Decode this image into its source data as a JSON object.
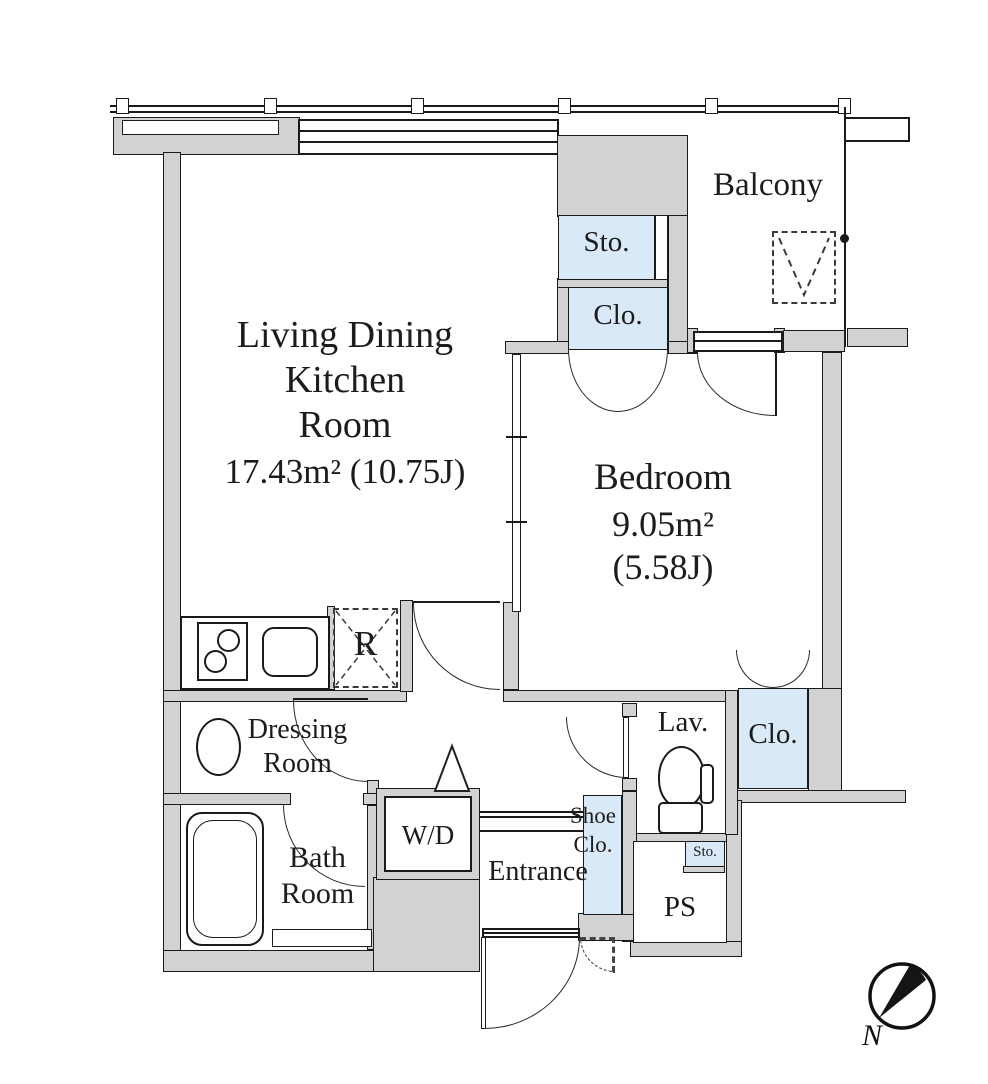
{
  "rooms": {
    "ldk": {
      "line1": "Living Dining",
      "line2": "Kitchen",
      "line3": "Room",
      "area": "17.43m²",
      "tatami": "(10.75J)"
    },
    "bedroom": {
      "name": "Bedroom",
      "area": "9.05m²",
      "tatami": "(5.58J)"
    },
    "balcony": {
      "name": "Balcony"
    },
    "sto_top": {
      "name": "Sto."
    },
    "clo_top": {
      "name": "Clo."
    },
    "dressing": {
      "line1": "Dressing",
      "line2": "Room"
    },
    "bath": {
      "line1": "Bath",
      "line2": "Room"
    },
    "wd": {
      "name": "W/D"
    },
    "entrance": {
      "name": "Entrance"
    },
    "shoe_closet": {
      "line1": "Shoe",
      "line2": "Clo."
    },
    "lavatory": {
      "name": "Lav."
    },
    "clo_bedroom": {
      "name": "Clo."
    },
    "sto_small": {
      "name": "Sto."
    },
    "ps": {
      "name": "PS"
    },
    "refrigerator": {
      "name": "R"
    }
  },
  "compass": {
    "north": "N"
  },
  "colors": {
    "wall": "#d2d2d2",
    "closet_fill": "#d9e9f7",
    "outline": "#1a1a1a"
  }
}
